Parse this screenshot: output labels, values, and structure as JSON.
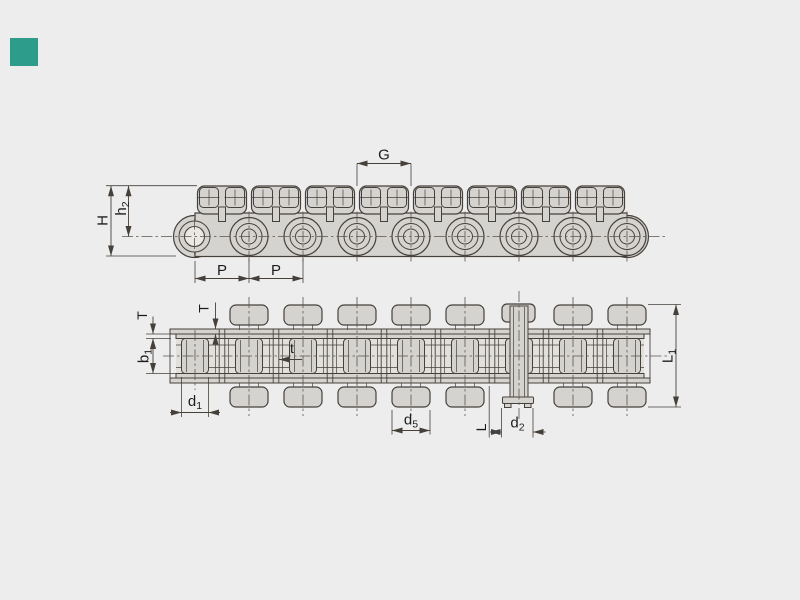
{
  "canvas": {
    "width": 800,
    "height": 600,
    "background": "#ededee"
  },
  "logo_square": {
    "color": "#2e9c8b"
  },
  "diagram": {
    "title": "roller-chain-technical-drawing",
    "views": [
      {
        "id": "side-view",
        "description": "Side elevation of roller chain with top attachment plates",
        "dimension_labels": [
          "H",
          "h2",
          "G",
          "P",
          "P"
        ]
      },
      {
        "id": "plan-view",
        "description": "Plan view of roller chain with attachments and one extended pin link",
        "dimension_labels": [
          "T",
          "T",
          "b1",
          "t",
          "d1",
          "d5",
          "L",
          "d2",
          "L1"
        ]
      }
    ],
    "colors": {
      "part_fill": "#d5d3d0",
      "cavity_fill": "#e2e0dd",
      "line": "#46403a",
      "text": "#1d1c1b",
      "background": "#ededee"
    },
    "chain": {
      "pitch_count": 8,
      "roller_count": 8,
      "tabs_per_link": 2,
      "extended_pin_link_center_index": 6
    },
    "labels": {
      "G": "G",
      "H": "H",
      "P1": "P",
      "P2": "P",
      "h_main": "h",
      "h_sub": "2",
      "T1": "T",
      "T2": "T",
      "b_main": "b",
      "b_sub": "1",
      "t": "t",
      "d1_main": "d",
      "d1_sub": "1",
      "d5_main": "d",
      "d5_sub": "5",
      "L": "L",
      "d2_main": "d",
      "d2_sub": "2",
      "L1_main": "L",
      "L1_sub": "1"
    }
  }
}
